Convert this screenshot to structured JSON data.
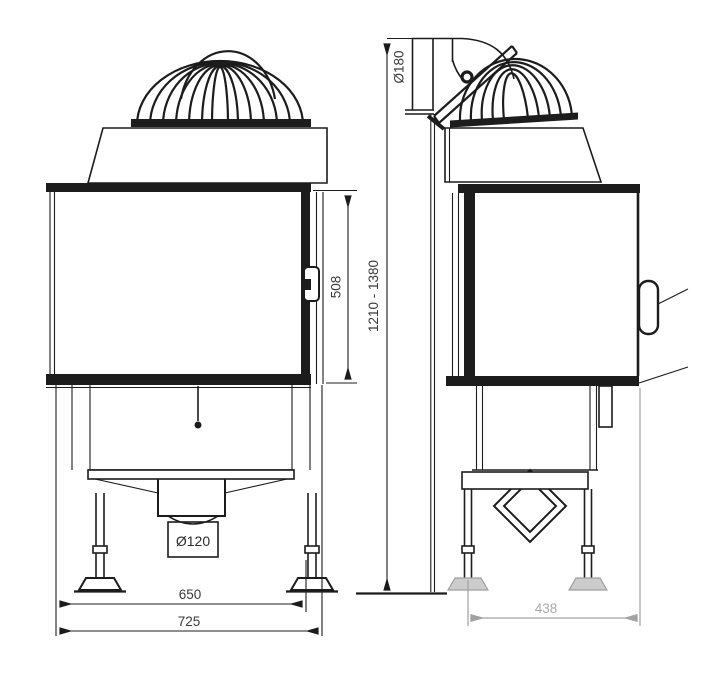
{
  "drawing": {
    "colors": {
      "line": "#1c1c1c",
      "secondary_dimension": "#a2a2a2",
      "background": "#ffffff"
    },
    "labels": {
      "flue_diameter": "Ø180",
      "height_range": "1210 - 1380",
      "door_height": "508",
      "intake_diameter": "Ø120",
      "inner_width": "650",
      "overall_width": "725",
      "depth": "438"
    }
  }
}
